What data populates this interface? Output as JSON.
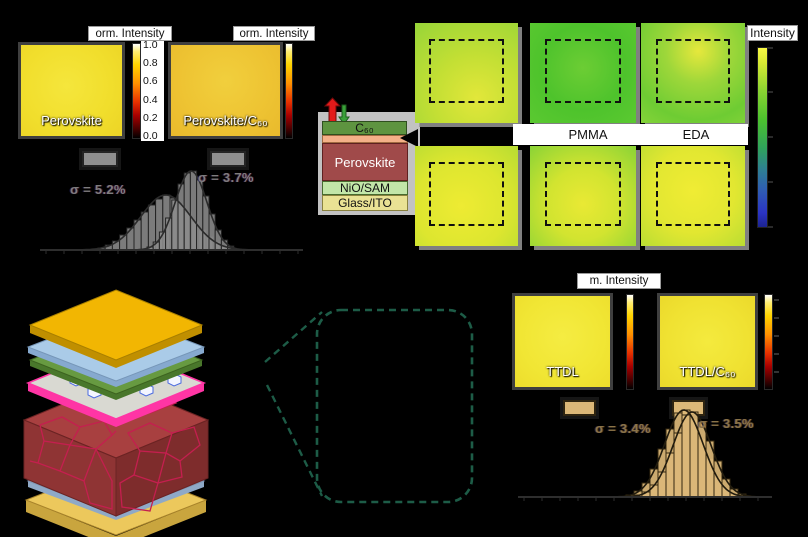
{
  "figure": {
    "background": "#000000",
    "description_visible_only": true
  },
  "panel_perovskite": {
    "colorbar_title_left": "orm. Intensity",
    "colorbar_title_right": "orm. Intensity",
    "colorbar_ticks": [
      "1.0",
      "0.8",
      "0.6",
      "0.4",
      "0.2",
      "0.0"
    ],
    "maps": [
      {
        "label": "Perovskite",
        "fill": "#f2e02f"
      },
      {
        "label": "Perovskite/C₆₀",
        "fill": "#eec637"
      }
    ]
  },
  "device_stack": {
    "layers": [
      {
        "label": "C₆₀",
        "color": "#5e9440"
      },
      {
        "label": "",
        "color": "#f4b088"
      },
      {
        "label": "Perovskite",
        "color": "#a04a4a"
      },
      {
        "label": "NiO/SAM",
        "color": "#c2e6a8"
      },
      {
        "label": "Glass/ITO",
        "color": "#eae294"
      }
    ],
    "arrows": [
      {
        "name": "up-arrow",
        "color": "#e31a1a"
      },
      {
        "name": "down-arrow",
        "color": "#39a039"
      }
    ]
  },
  "panel_passivation": {
    "colorbar_title": "Intensity",
    "labels": [
      "PMMA",
      "EDA"
    ],
    "colormap": [
      "#f8f845",
      "#4cc22e",
      "#2b34c4"
    ]
  },
  "panel_ttdl": {
    "colorbar_title": "m. Intensity",
    "maps": [
      {
        "label": "TTDL",
        "fill": "#f2e83a"
      },
      {
        "label": "TTDL/C₆₀",
        "fill": "#f0e434"
      }
    ]
  },
  "structure3d": {
    "colors": {
      "gold_top": "#f2b602",
      "gold_top_edge": "#c08f00",
      "blue": "#aacbe8",
      "blue_edge": "#86a9cf",
      "green": "#679a41",
      "green_edge": "#49772b",
      "plate": "#d9d9d2",
      "plate_edge": "#ff35a5",
      "perovskite_top": "#a84040",
      "perovskite_left": "#8f3434",
      "perovskite_right": "#7e2c2c",
      "grain": "#c41f4f",
      "lgreen": "#bcdc8e",
      "lgreen_edge": "#96bb66",
      "lblue": "#b4c9e4",
      "lblue_edge": "#8fa9c7",
      "gold_bottom": "#ecc85c",
      "gold_bottom_edge": "#c9a53e",
      "molecule_fill": "#f4f6ff",
      "molecule_stroke": "#4a6adf"
    }
  },
  "zoom_callout": {
    "stroke": "#1d5c47"
  },
  "chart_data": [
    {
      "type": "bar",
      "title": "Normalized PL intensity histograms (gray)",
      "legend_position": "above-peaks",
      "grid": false,
      "series": [
        {
          "name": "Perovskite",
          "sigma": "σ = 5.2%",
          "color": "#8a8a8a",
          "bins": [
            2,
            5,
            9,
            15,
            22,
            30,
            38,
            45,
            51,
            55,
            52,
            46,
            38,
            29,
            20,
            13,
            8,
            4,
            2
          ]
        },
        {
          "name": "Perovskite/C₆₀",
          "sigma": "σ = 3.7%",
          "color": "#8a8a8a",
          "bins": [
            3,
            8,
            18,
            32,
            50,
            66,
            77,
            79,
            70,
            54,
            36,
            20,
            10,
            4
          ]
        }
      ]
    },
    {
      "type": "bar",
      "title": "Normalized PL intensity histograms (tan)",
      "legend_position": "above-peaks",
      "grid": false,
      "series": [
        {
          "name": "TTDL",
          "sigma": "σ = 3.4%",
          "color": "#dcb878",
          "bins": [
            2,
            6,
            14,
            28,
            48,
            68,
            84,
            87,
            78,
            58,
            38,
            20,
            9,
            3
          ]
        },
        {
          "name": "TTDL/C₆₀",
          "sigma": "σ = 3.5%",
          "color": "#dcb878",
          "bins": [
            2,
            5,
            12,
            25,
            44,
            64,
            82,
            85,
            75,
            56,
            36,
            18,
            8,
            3
          ]
        }
      ]
    }
  ]
}
